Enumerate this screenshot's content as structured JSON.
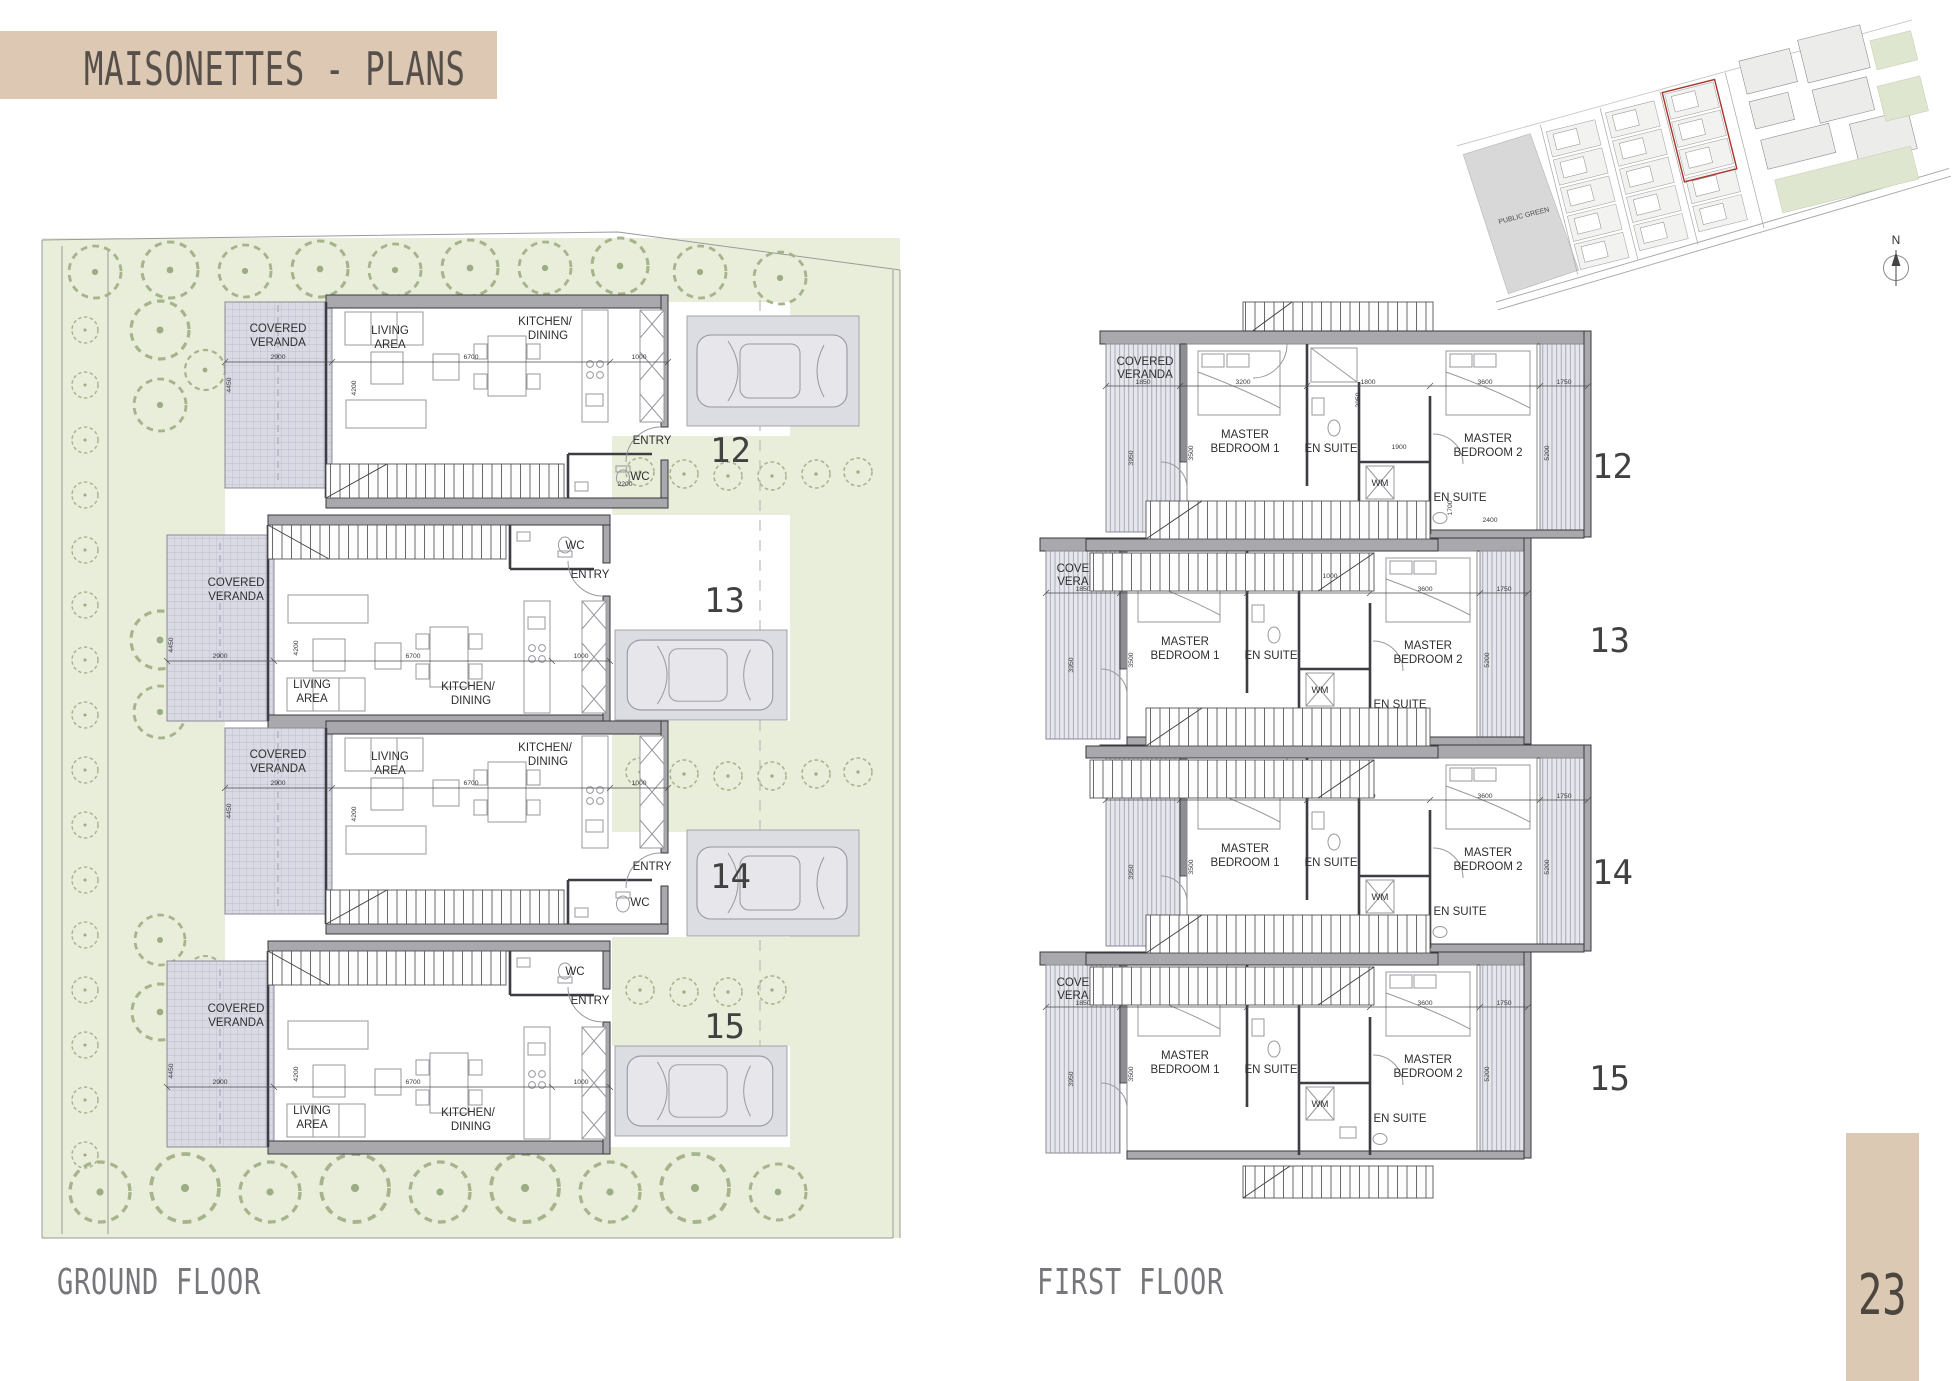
{
  "page": {
    "title": "MAISONETTES - PLANS",
    "page_number": "23",
    "ground_caption": "GROUND FLOOR",
    "first_caption": "FIRST FLOOR"
  },
  "labels": {
    "covered": "COVERED",
    "veranda": "VERANDA",
    "living": "LIVING",
    "area": "AREA",
    "kitchen": "KITCHEN/",
    "dining": "DINING",
    "wc": "WC",
    "entry": "ENTRY",
    "master": "MASTER",
    "bedroom1": "BEDROOM 1",
    "bedroom2": "BEDROOM 2",
    "ensuite": "EN SUITE",
    "wm": "WM"
  },
  "units": {
    "u12": "12",
    "u13": "13",
    "u14": "14",
    "u15": "15"
  },
  "site": {
    "public_green": "PUBLIC GREEN",
    "north": "N"
  },
  "dims_gf": {
    "w_veranda": "2900",
    "w_living": "6700",
    "w_kitchen": "1000",
    "h_veranda": "4450",
    "h_living": "4200",
    "w_wc": "2200"
  },
  "dims_ff": {
    "w_veranda": "1850",
    "w_bed1": "3200",
    "w_core": "1800",
    "w_bed2": "3600",
    "w_balcony": "1750",
    "h_veranda": "3950",
    "h_bed1": "3500",
    "h_unit": "5200",
    "w_wm": "2400",
    "h_hall": "1700",
    "h_ensuite": "2950",
    "w_door": "1900",
    "w_stair": "1000"
  }
}
